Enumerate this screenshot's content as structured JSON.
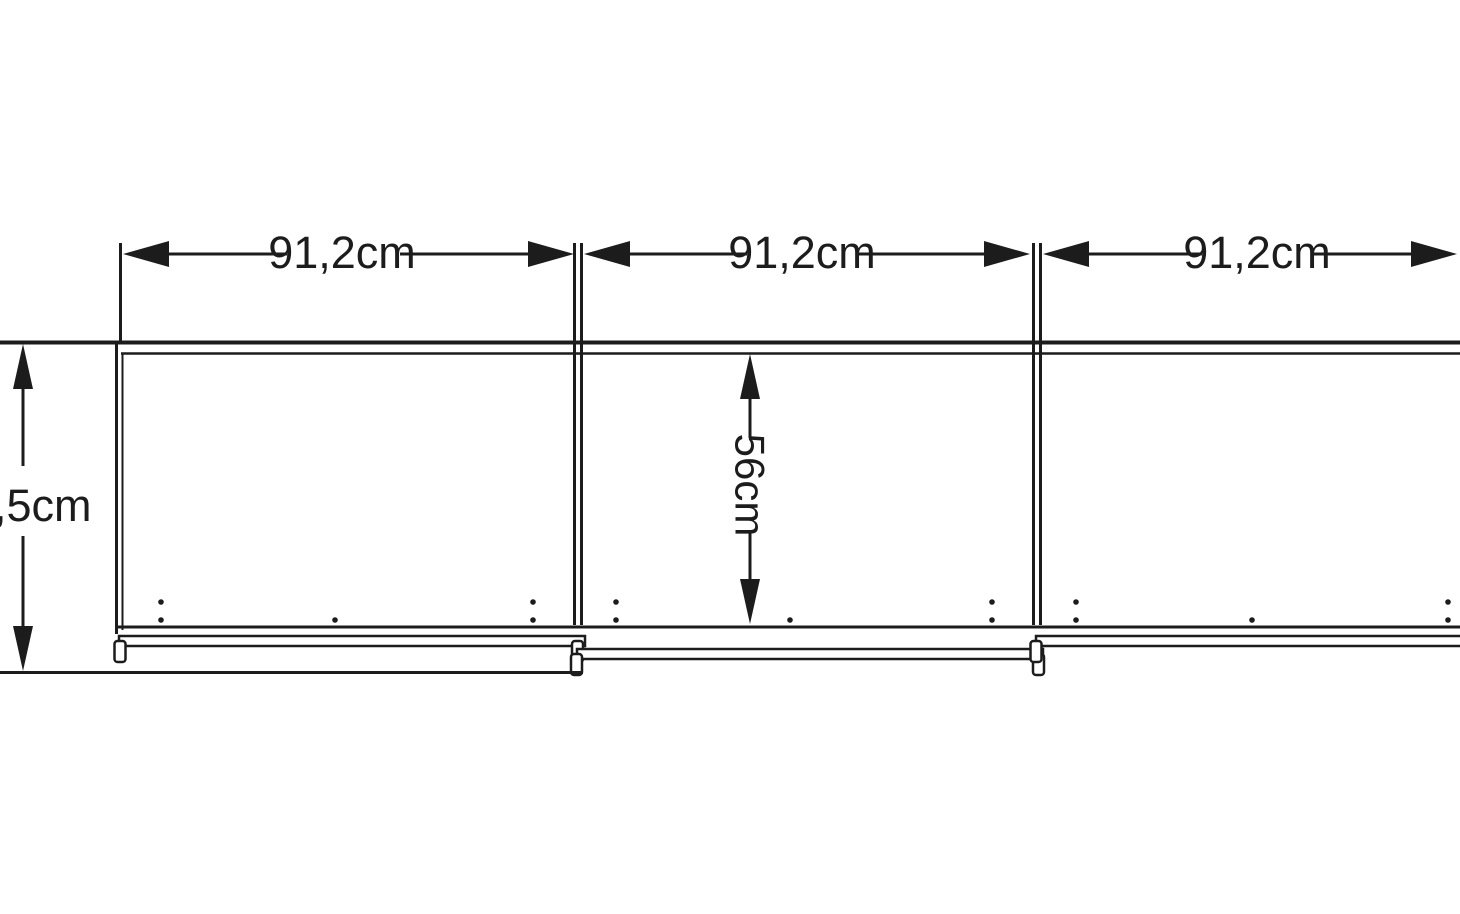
{
  "diagram": {
    "type": "technical-drawing",
    "subject": "three-door sliding wardrobe, plan view with dimension annotations",
    "background_color": "#ffffff",
    "line_color": "#1c1c1c",
    "dimensions": {
      "section_widths": [
        {
          "label": "91,2cm",
          "value_cm": 91.2
        },
        {
          "label": "91,2cm",
          "value_cm": 91.2
        },
        {
          "label": "91,2cm",
          "value_cm": 91.2
        }
      ],
      "total_depth": {
        "label": ",5cm"
      },
      "interior_depth": {
        "label": "56cm",
        "value_cm": 56
      }
    }
  }
}
